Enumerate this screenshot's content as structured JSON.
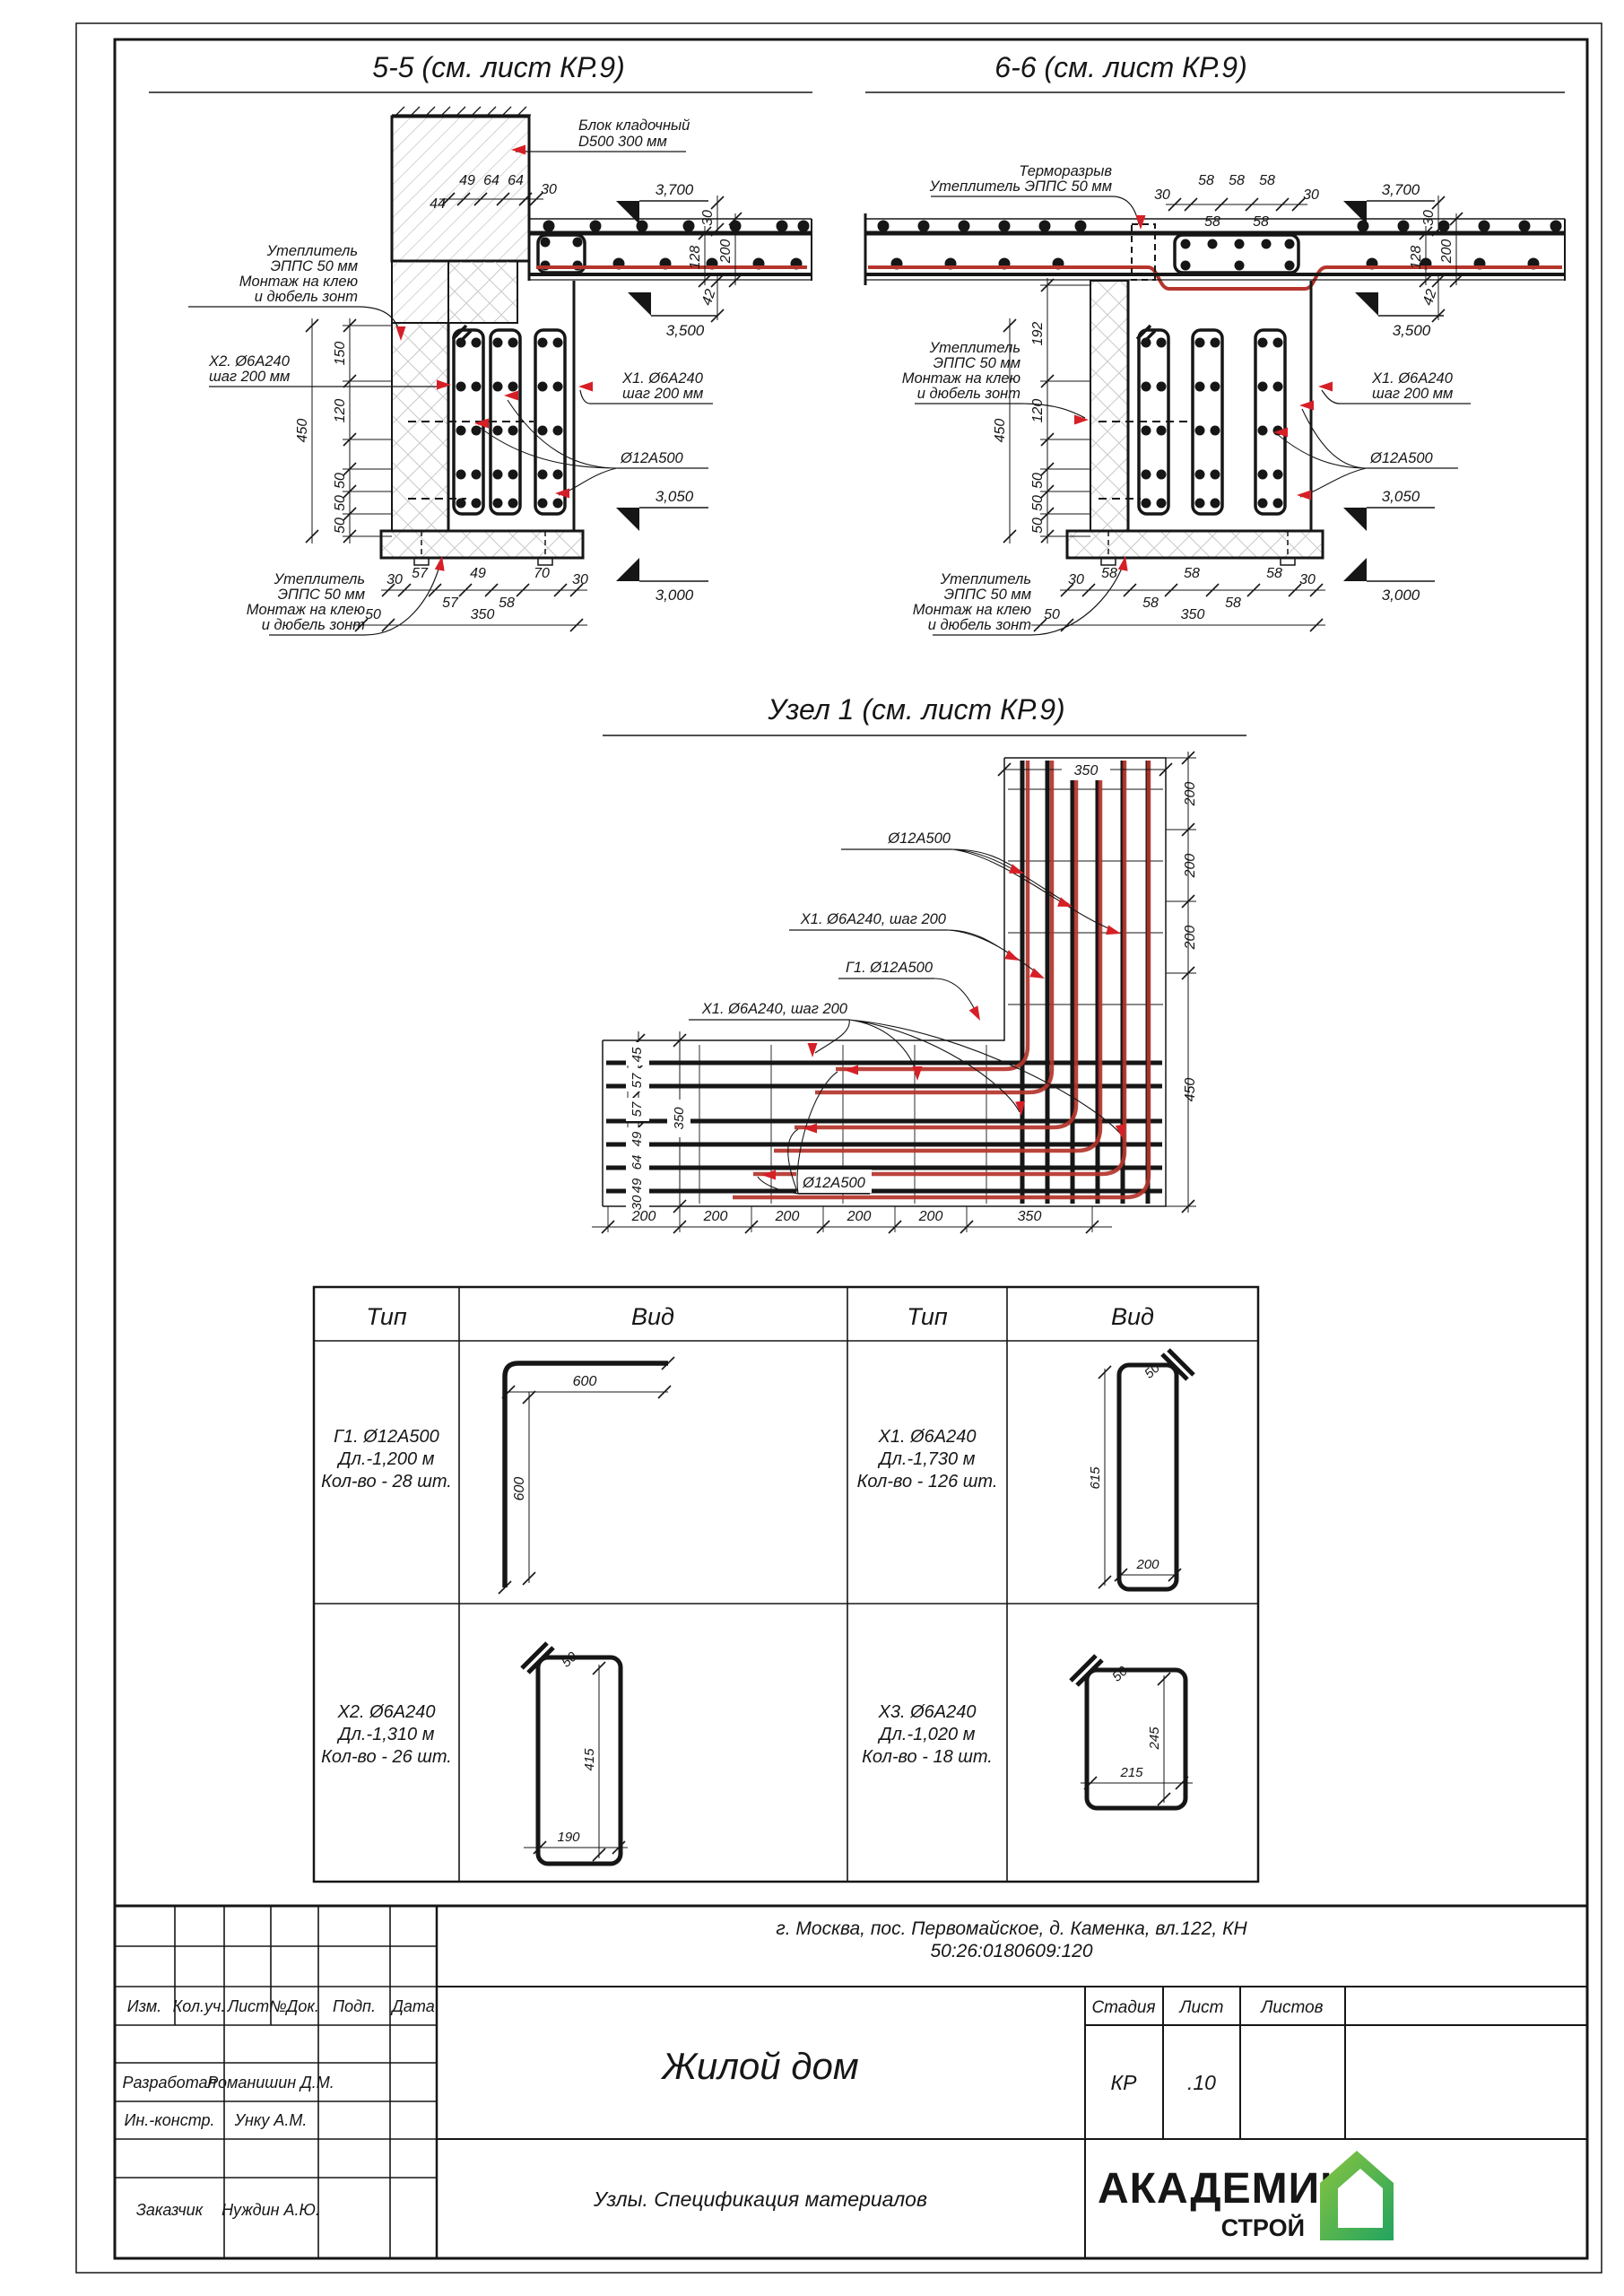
{
  "colors": {
    "ink": "#161616",
    "red_arrow": "#d61f26",
    "rebar_red": "#b5352b",
    "logo_green": "#72bf44",
    "logo_blue": "#2579be"
  },
  "s55": {
    "title": "5-5 (см. лист КР.9)",
    "block": [
      "Блок кладочный",
      "D500 300 мм"
    ],
    "insul_top": [
      "Утеплитель",
      "ЭППС 50 мм",
      "Монтаж на клею",
      "и дюбель зонт"
    ],
    "x2": [
      "Х2. Ø6А240",
      "шаг 200 мм"
    ],
    "x1": [
      "Х1. Ø6А240",
      "шаг 200 мм"
    ],
    "d12": "Ø12А500",
    "insul_bot": [
      "Утеплитель",
      "ЭППС 50 мм",
      "Монтаж на клею",
      "и дюбель зонт"
    ],
    "elev": [
      "3,700",
      "3,500",
      "3,050",
      "3,000"
    ],
    "dim_top": [
      "44",
      "49",
      "64",
      "64",
      "30"
    ],
    "dim_right": [
      "30",
      "128",
      "200",
      "42"
    ],
    "dim_left": [
      "150",
      "120",
      "50",
      "50",
      "50",
      "450"
    ],
    "dim_bot1": [
      "30",
      "57",
      "49",
      "70",
      "30"
    ],
    "dim_bot2": [
      "57",
      "58"
    ],
    "dim_bot3": [
      "50",
      "350"
    ]
  },
  "s66": {
    "title": "6-6 (см. лист КР.9)",
    "thermo": [
      "Терморазрыв",
      "Утеплитель ЭППС 50 мм"
    ],
    "insul_left": [
      "Утеплитель",
      "ЭППС 50 мм",
      "Монтаж на клею",
      "и дюбель зонт"
    ],
    "x1": [
      "Х1. Ø6А240",
      "шаг 200 мм"
    ],
    "d12": "Ø12А500",
    "insul_bot": [
      "Утеплитель",
      "ЭППС 50 мм",
      "Монтаж на клею",
      "и дюбель зонт"
    ],
    "elev": [
      "3,700",
      "3,500",
      "3,050",
      "3,000"
    ],
    "dim_top1": [
      "30",
      "58",
      "58",
      "58",
      "30"
    ],
    "dim_top2": [
      "58",
      "58"
    ],
    "dim_right": [
      "30",
      "128",
      "200",
      "42"
    ],
    "dim_left": [
      "192",
      "120",
      "50",
      "50",
      "50",
      "450"
    ],
    "dim_bot1": [
      "30",
      "58",
      "58",
      "58",
      "30"
    ],
    "dim_bot2": [
      "58",
      "58"
    ],
    "dim_bot3": [
      "50",
      "350"
    ]
  },
  "node1": {
    "title": "Узел 1 (см. лист КР.9)",
    "labels": [
      "Ø12А500",
      "Х1. Ø6А240, шаг 200",
      "Г1. Ø12А500",
      "Х1. Ø6А240, шаг 200",
      "Ø12А500"
    ],
    "dim_top": "350",
    "dim_right": [
      "200",
      "200",
      "200",
      "450"
    ],
    "dim_left": [
      "45",
      "57",
      "57",
      "49",
      "64",
      "49",
      "30"
    ],
    "dim_left_total": "350",
    "dim_bot": [
      "200",
      "200",
      "200",
      "200",
      "200",
      "350"
    ]
  },
  "table": {
    "headers": [
      "Тип",
      "Вид",
      "Тип",
      "Вид"
    ],
    "g1": {
      "lines": [
        "Г1. Ø12А500",
        "Дл.-1,200 м",
        "Кол-во - 28 шт."
      ],
      "dims": [
        "600",
        "600"
      ]
    },
    "x1": {
      "lines": [
        "Х1. Ø6А240",
        "Дл.-1,730 м",
        "Кол-во - 126 шт."
      ],
      "dims": [
        "50",
        "615",
        "200"
      ]
    },
    "x2": {
      "lines": [
        "Х2. Ø6А240",
        "Дл.-1,310 м",
        "Кол-во - 26 шт."
      ],
      "dims": [
        "50",
        "415",
        "190"
      ]
    },
    "x3": {
      "lines": [
        "Х3. Ø6А240",
        "Дл.-1,020 м",
        "Кол-во - 18 шт."
      ],
      "dims": [
        "50",
        "245",
        "215"
      ]
    }
  },
  "tb": {
    "address": [
      "г. Москва, пос. Первомайское, д. Каменка, вл.122, КН",
      "50:26:0180609:120"
    ],
    "cols": [
      "Изм.",
      "Кол.уч.",
      "Лист",
      "№Док.",
      "Подп.",
      "Дата"
    ],
    "rows": [
      {
        "role": "Разработал",
        "name": "Романишин Д.М."
      },
      {
        "role": "Ин.-констр.",
        "name": "Унку А.М."
      },
      {
        "role": "Заказчик",
        "name": "Нуждин А.Ю."
      }
    ],
    "project": "Жилой дом",
    "stage_cols": [
      "Стадия",
      "Лист",
      "Листов"
    ],
    "stage": "КР",
    "sheet": ".10",
    "doc": "Узлы. Спецификация материалов",
    "logo": [
      "АКАДЕМИК",
      "СТРОЙ"
    ]
  }
}
